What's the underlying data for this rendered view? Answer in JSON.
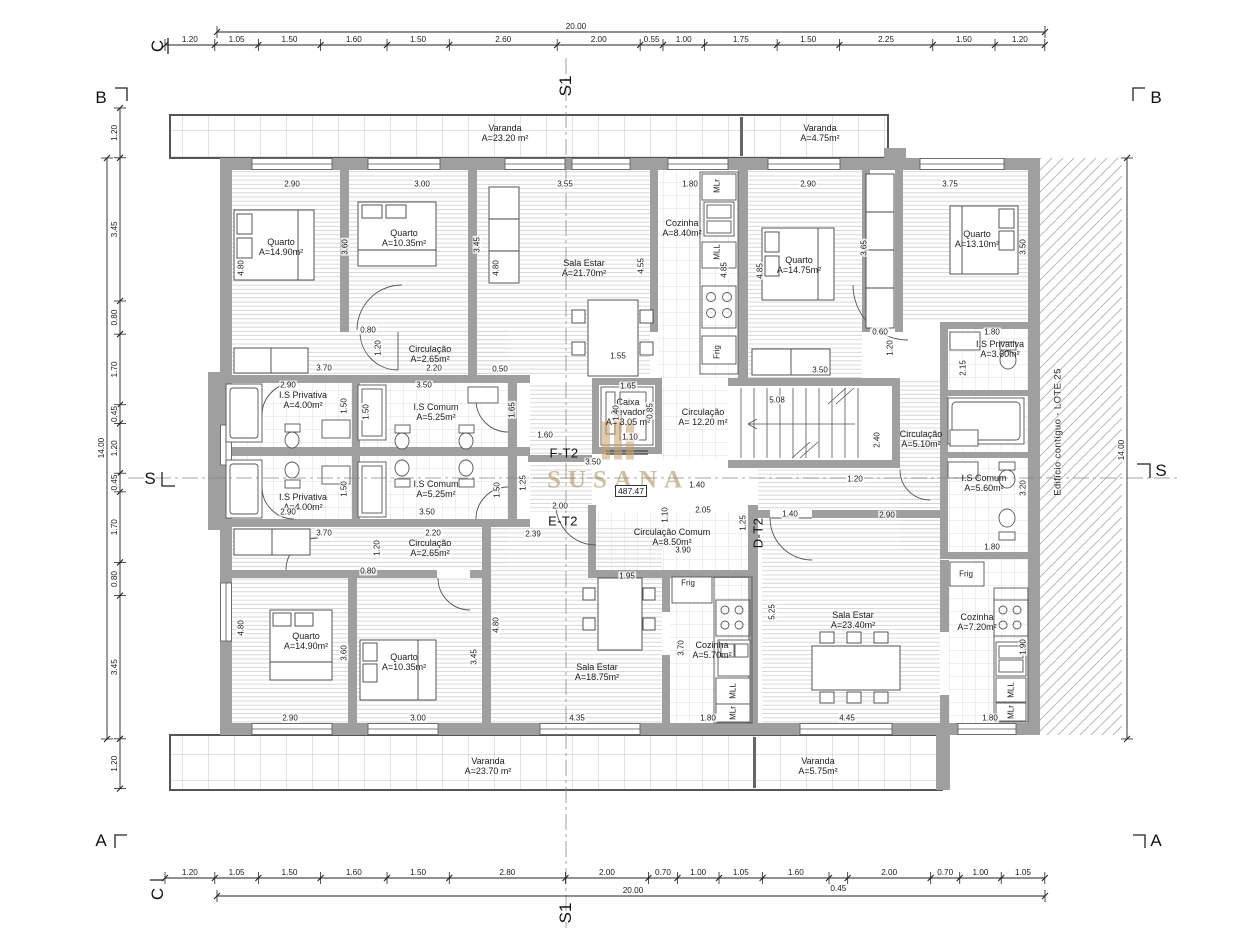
{
  "meta": {
    "watermark_name": "SUSANA",
    "level_value": "487.47",
    "adjacent_building_label": "Edifício contíguo - LOTE 25"
  },
  "dim_chains": {
    "top": {
      "segments": [
        "1.20",
        "1.05",
        "1.50",
        "1.60",
        "1.50",
        "2.60",
        "2.00",
        "0.55",
        "1.00",
        "1.75",
        "1.50",
        "2.25",
        "1.50",
        "1.20"
      ]
    },
    "bottom": {
      "segments": [
        "1.20",
        "1.05",
        "1.50",
        "1.60",
        "1.50",
        "2.80",
        "2.00",
        "0.70",
        "1.00",
        "1.05",
        "1.60",
        "0.45",
        "2.00",
        "0.70",
        "1.00",
        "1.05"
      ]
    },
    "left": {
      "segments": [
        "1.20",
        "3.45",
        "0.80",
        "1.70",
        "0.45",
        "1.20",
        "0.45",
        "1.70",
        "0.80",
        "3.45",
        "1.20"
      ]
    },
    "overall": {
      "top": "20.00",
      "bottom": "20.00",
      "left": "14.00",
      "right": "14.00"
    }
  },
  "rooms": [
    {
      "name": "Varanda",
      "area": "A=23.20 m²",
      "x": 505,
      "y": 133
    },
    {
      "name": "Varanda",
      "area": "A=4.75m²",
      "x": 820,
      "y": 133
    },
    {
      "name": "Quarto",
      "area": "A=14.90m²",
      "x": 281,
      "y": 247
    },
    {
      "name": "Quarto",
      "area": "A=10.35m²",
      "x": 404,
      "y": 238
    },
    {
      "name": "Sala Estar",
      "area": "A=21.70m²",
      "x": 584,
      "y": 268
    },
    {
      "name": "Cozinha",
      "area": "A=8.40m²",
      "x": 682,
      "y": 228
    },
    {
      "name": "Quarto",
      "area": "A=14.75m²",
      "x": 799,
      "y": 265
    },
    {
      "name": "Quarto",
      "area": "A=13.10m²",
      "x": 977,
      "y": 239
    },
    {
      "name": "Circulação",
      "area": "A=2.65m²",
      "x": 430,
      "y": 354
    },
    {
      "name": "I.S Privativa",
      "area": "A=4.00m²",
      "x": 303,
      "y": 400
    },
    {
      "name": "I.S Comum",
      "area": "A=5.25m²",
      "x": 436,
      "y": 412
    },
    {
      "name": "I.S Privativa",
      "area": "A=3.60m²",
      "x": 1000,
      "y": 349
    },
    {
      "name": "Caixa elevador",
      "area": "A= 3.05 m²",
      "x": 628,
      "y": 412,
      "w": 52
    },
    {
      "name": "Circulação",
      "area": "A= 12.20 m²",
      "x": 703,
      "y": 417
    },
    {
      "name": "Circulação",
      "area": "A=5.10m²",
      "x": 921,
      "y": 439
    },
    {
      "name": "I.S Comum",
      "area": "A=5.60m²",
      "x": 984,
      "y": 483
    },
    {
      "name": "I.S Comum",
      "area": "A=5.25m²",
      "x": 436,
      "y": 489
    },
    {
      "name": "I.S Privativa",
      "area": "A=4.00m²",
      "x": 303,
      "y": 502
    },
    {
      "name": "Circulação",
      "area": "A=2.65m²",
      "x": 430,
      "y": 548
    },
    {
      "name": "Circulação Comum",
      "area": "A=8.50m²",
      "x": 672,
      "y": 537,
      "w": 116
    },
    {
      "name": "Quarto",
      "area": "A=14.90m²",
      "x": 306,
      "y": 641
    },
    {
      "name": "Quarto",
      "area": "A=10.35m²",
      "x": 404,
      "y": 662
    },
    {
      "name": "Sala Estar",
      "area": "A=18.75m²",
      "x": 597,
      "y": 672
    },
    {
      "name": "Cozinha",
      "area": "A=5.70m²",
      "x": 712,
      "y": 650
    },
    {
      "name": "Sala Estar",
      "area": "A=23.40m²",
      "x": 853,
      "y": 620
    },
    {
      "name": "Cozinha",
      "area": "A=7.20m²",
      "x": 977,
      "y": 622
    },
    {
      "name": "Varanda",
      "area": "A=23.70 m²",
      "x": 488,
      "y": 766
    },
    {
      "name": "Varanda",
      "area": "A=5.75m²",
      "x": 818,
      "y": 766
    }
  ],
  "unit_labels": [
    {
      "label": "F-T2",
      "x": 564,
      "y": 453
    },
    {
      "label": "E-T2",
      "x": 563,
      "y": 521
    },
    {
      "label": "D-T2",
      "x": 758,
      "y": 533,
      "rotate": 1
    }
  ],
  "section_marks": [
    {
      "label": "C",
      "x": 158,
      "y": 46,
      "rotate": 1
    },
    {
      "label": "S1",
      "x": 566,
      "y": 86,
      "rotate": 1
    },
    {
      "label": "B",
      "x": 101,
      "y": 98
    },
    {
      "label": "B",
      "x": 1156,
      "y": 98
    },
    {
      "label": "S",
      "x": 150,
      "y": 479
    },
    {
      "label": "S",
      "x": 1161,
      "y": 471
    },
    {
      "label": "A",
      "x": 101,
      "y": 841
    },
    {
      "label": "A",
      "x": 1156,
      "y": 841
    },
    {
      "label": "C",
      "x": 158,
      "y": 894,
      "rotate": 1
    },
    {
      "label": "S1",
      "x": 566,
      "y": 913,
      "rotate": 1
    }
  ],
  "interior_dims": [
    [
      "2.90",
      292,
      184,
      0
    ],
    [
      "3.00",
      422,
      184,
      0
    ],
    [
      "3.55",
      565,
      184,
      0
    ],
    [
      "1.80",
      690,
      184,
      0
    ],
    [
      "2.90",
      808,
      184,
      0
    ],
    [
      "3.75",
      950,
      184,
      0
    ],
    [
      "4.80",
      241,
      268,
      1
    ],
    [
      "3.60",
      345,
      247,
      1
    ],
    [
      "3.45",
      477,
      245,
      1
    ],
    [
      "4.80",
      496,
      268,
      1
    ],
    [
      "4.55",
      641,
      266,
      1
    ],
    [
      "4.85",
      724,
      270,
      1
    ],
    [
      "4.85",
      760,
      271,
      1
    ],
    [
      "3.65",
      864,
      248,
      1
    ],
    [
      "3.50",
      1023,
      247,
      1
    ],
    [
      "0.80",
      368,
      330,
      0
    ],
    [
      "1.20",
      378,
      348,
      1
    ],
    [
      "3.70",
      324,
      368,
      0
    ],
    [
      "2.20",
      434,
      368,
      0
    ],
    [
      "0.50",
      500,
      369,
      0
    ],
    [
      "1.55",
      618,
      356,
      0
    ],
    [
      "1.65",
      628,
      386,
      0
    ],
    [
      "0.60",
      880,
      332,
      0
    ],
    [
      "1.20",
      890,
      348,
      1
    ],
    [
      "3.50",
      820,
      370,
      0
    ],
    [
      "1.80",
      992,
      332,
      0
    ],
    [
      "2.15",
      963,
      368,
      1
    ],
    [
      "2.90",
      288,
      385,
      0
    ],
    [
      "3.50",
      424,
      385,
      0
    ],
    [
      "1.50",
      344,
      406,
      1
    ],
    [
      "1.50",
      366,
      412,
      1
    ],
    [
      "1.65",
      512,
      410,
      1
    ],
    [
      "1.40",
      616,
      413,
      1
    ],
    [
      "0.85",
      650,
      411,
      1
    ],
    [
      "1.10",
      630,
      437,
      0
    ],
    [
      "1.60",
      545,
      435,
      0
    ],
    [
      "5.08",
      777,
      400,
      0
    ],
    [
      "2.40",
      877,
      440,
      1
    ],
    [
      "3.50",
      593,
      462,
      0
    ],
    [
      "1.10",
      665,
      515,
      1
    ],
    [
      "1.40",
      697,
      485,
      0
    ],
    [
      "1.20",
      855,
      479,
      0
    ],
    [
      "1.50",
      344,
      489,
      1
    ],
    [
      "1.50",
      497,
      490,
      1
    ],
    [
      "1.25",
      523,
      483,
      1
    ],
    [
      "2.90",
      288,
      512,
      0
    ],
    [
      "3.50",
      427,
      512,
      0
    ],
    [
      "2.00",
      560,
      506,
      0
    ],
    [
      "2.39",
      533,
      534,
      0
    ],
    [
      "2.05",
      703,
      510,
      0
    ],
    [
      "1.25",
      743,
      523,
      1
    ],
    [
      "1.40",
      790,
      514,
      0
    ],
    [
      "2.90",
      887,
      515,
      0
    ],
    [
      "3.90",
      683,
      550,
      0
    ],
    [
      "3.70",
      324,
      533,
      0
    ],
    [
      "2.20",
      433,
      533,
      0
    ],
    [
      "1.20",
      377,
      548,
      1
    ],
    [
      "0.80",
      368,
      571,
      0
    ],
    [
      "3.20",
      1023,
      488,
      1
    ],
    [
      "1.80",
      992,
      547,
      0
    ],
    [
      "1.95",
      627,
      576,
      0
    ],
    [
      "4.80",
      241,
      628,
      1
    ],
    [
      "3.60",
      344,
      653,
      1
    ],
    [
      "3.45",
      474,
      657,
      1
    ],
    [
      "4.80",
      496,
      625,
      1
    ],
    [
      "3.70",
      681,
      648,
      1
    ],
    [
      "5.25",
      772,
      612,
      1
    ],
    [
      "1.90",
      1023,
      647,
      1
    ],
    [
      "2.90",
      290,
      718,
      0
    ],
    [
      "3.00",
      418,
      718,
      0
    ],
    [
      "4.35",
      577,
      718,
      0
    ],
    [
      "1.80",
      708,
      718,
      0
    ],
    [
      "4.45",
      847,
      718,
      0
    ],
    [
      "1.80",
      990,
      718,
      0
    ]
  ],
  "appliance_labels": [
    [
      "MLr",
      717,
      186,
      1
    ],
    [
      "MLL",
      717,
      252,
      1
    ],
    [
      "Frig",
      717,
      352,
      1
    ],
    [
      "Frig",
      688,
      583,
      0
    ],
    [
      "MLL",
      733,
      691,
      1
    ],
    [
      "MLr",
      733,
      713,
      1
    ],
    [
      "Frig",
      966,
      574,
      0
    ],
    [
      "MLL",
      1011,
      690,
      1
    ],
    [
      "MLr",
      1011,
      712,
      1
    ]
  ]
}
